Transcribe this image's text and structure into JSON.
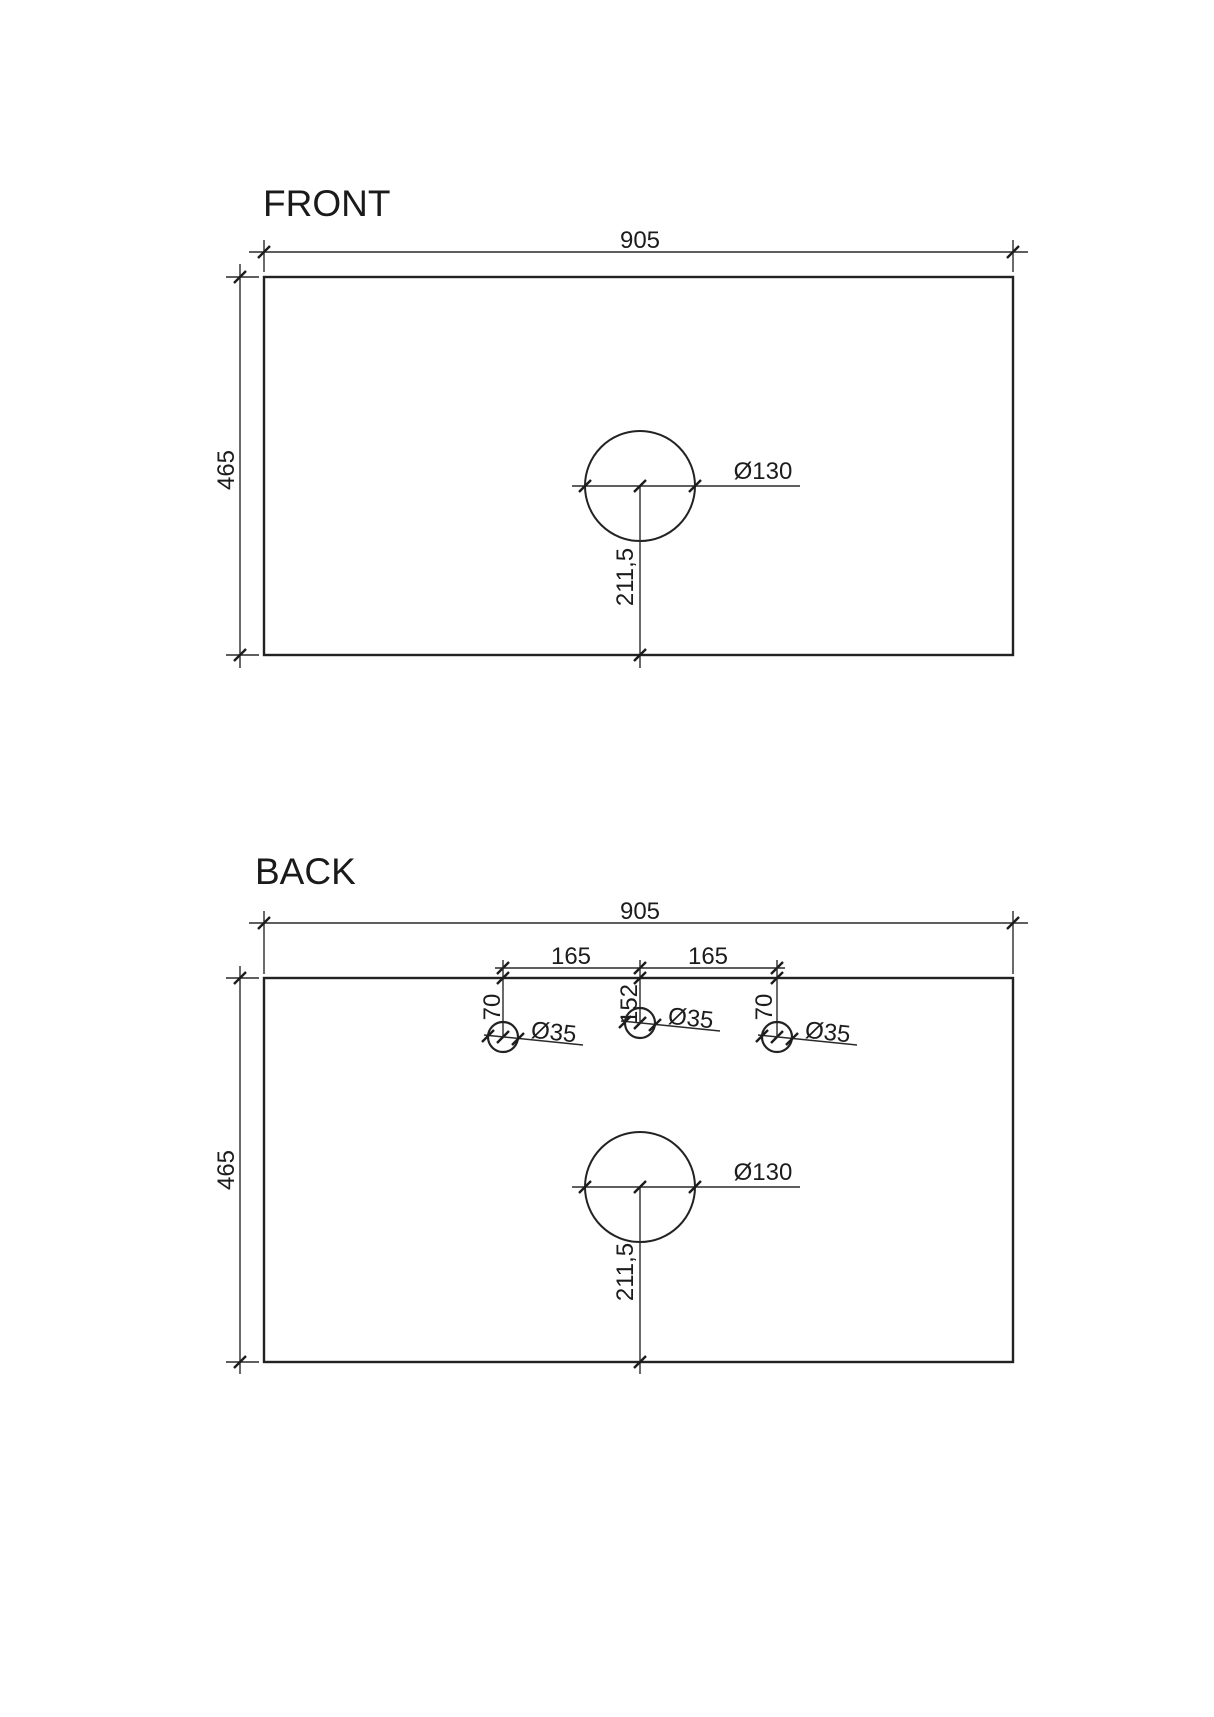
{
  "front_view": {
    "title": "FRONT",
    "width": "905",
    "height": "465",
    "basin_hole": {
      "diameter": "Ø130",
      "center_from_bottom": "211,5"
    }
  },
  "back_view": {
    "title": "BACK",
    "width": "905",
    "height": "465",
    "basin_hole": {
      "diameter": "Ø130",
      "center_from_bottom": "211,5"
    },
    "tap_hole_spacing": {
      "left": "165",
      "right": "165"
    },
    "tap_holes": [
      {
        "position": "left",
        "from_top": "70",
        "diameter": "Ø35"
      },
      {
        "position": "middle",
        "from_top": "152",
        "diameter": "Ø35"
      },
      {
        "position": "right",
        "from_top": "70",
        "diameter": "Ø35"
      }
    ]
  },
  "colors": {
    "line": "#222222",
    "text": "#1c1c1c",
    "background": "#ffffff"
  }
}
